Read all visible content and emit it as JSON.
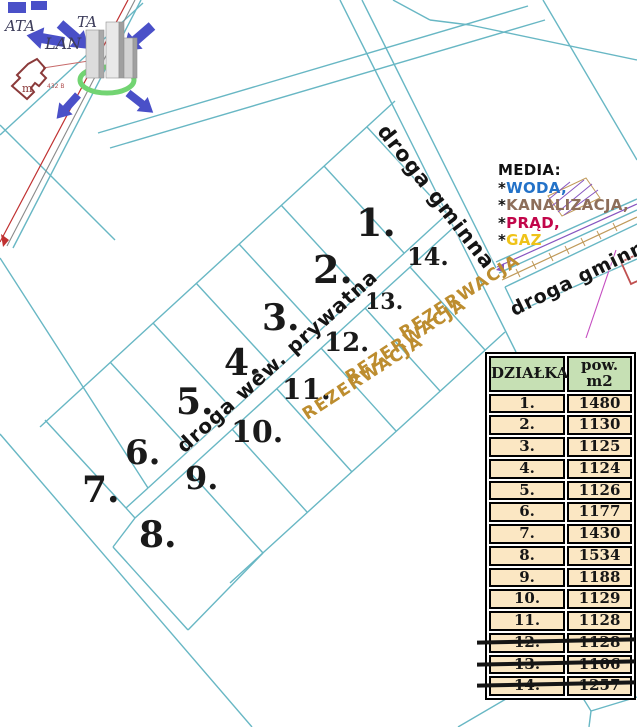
{
  "colors": {
    "parcel_line": "#68b7c4",
    "reservation_text": "#bd8d2f",
    "table_header_bg": "#c6e0b4",
    "table_row_bg": "#fbe7c3",
    "logo_blue": "#4a50c8",
    "logo_green": "#72d472",
    "red_line": "#c03030"
  },
  "logo": {
    "text_left": "ATA",
    "text_right": "TA",
    "text_bottom": "LAN"
  },
  "map": {
    "building_label": "m",
    "building_note": "432 B",
    "plots": [
      {
        "label": "1.",
        "x": 356,
        "y": 204,
        "fs": 38
      },
      {
        "label": "2.",
        "x": 313,
        "y": 251,
        "fs": 38
      },
      {
        "label": "3.",
        "x": 262,
        "y": 300,
        "fs": 36
      },
      {
        "label": "4.",
        "x": 224,
        "y": 345,
        "fs": 36
      },
      {
        "label": "5.",
        "x": 176,
        "y": 384,
        "fs": 36
      },
      {
        "label": "6.",
        "x": 125,
        "y": 436,
        "fs": 34
      },
      {
        "label": "7.",
        "x": 82,
        "y": 472,
        "fs": 36
      },
      {
        "label": "8.",
        "x": 139,
        "y": 517,
        "fs": 36
      },
      {
        "label": "9.",
        "x": 185,
        "y": 462,
        "fs": 32
      },
      {
        "label": "10.",
        "x": 231,
        "y": 418,
        "fs": 30
      },
      {
        "label": "11.",
        "x": 282,
        "y": 376,
        "fs": 28
      },
      {
        "label": "12.",
        "x": 324,
        "y": 330,
        "fs": 26
      },
      {
        "label": "13.",
        "x": 365,
        "y": 291,
        "fs": 22
      },
      {
        "label": "14.",
        "x": 407,
        "y": 245,
        "fs": 24
      }
    ],
    "reservations": [
      {
        "label": "REZERWACJA",
        "x": 460,
        "y": 297,
        "rot": -33
      },
      {
        "label": "REZERWACJA",
        "x": 406,
        "y": 341,
        "rot": -33
      },
      {
        "label": "REZERWACJA",
        "x": 363,
        "y": 378,
        "rot": -33
      }
    ],
    "roads": [
      {
        "label": "droga gminna",
        "x": 436,
        "y": 197,
        "rot": 52,
        "fs": 21
      },
      {
        "label": "droga wew. prywatna",
        "x": 277,
        "y": 361,
        "rot": -42,
        "fs": 20
      },
      {
        "label": "droga gminna",
        "x": 584,
        "y": 276,
        "rot": -26,
        "fs": 19
      }
    ]
  },
  "media": {
    "title": "MEDIA:",
    "items": [
      {
        "star": "*",
        "word": "WODA,",
        "color": "#2372c8"
      },
      {
        "star": "*",
        "word": "KANALIZACJA,",
        "color": "#8d6e5a"
      },
      {
        "star": "*",
        "word": "PRĄD,",
        "color": "#c2064a"
      },
      {
        "star": "*",
        "word": "GAZ",
        "color": "#efc319"
      }
    ]
  },
  "table": {
    "headers": [
      "DZIAŁKA",
      "pow. m2"
    ],
    "rows": [
      {
        "plot": "1.",
        "area": "1480",
        "struck": false
      },
      {
        "plot": "2.",
        "area": "1130",
        "struck": false
      },
      {
        "plot": "3.",
        "area": "1125",
        "struck": false
      },
      {
        "plot": "4.",
        "area": "1124",
        "struck": false
      },
      {
        "plot": "5.",
        "area": "1126",
        "struck": false
      },
      {
        "plot": "6.",
        "area": "1177",
        "struck": false
      },
      {
        "plot": "7.",
        "area": "1430",
        "struck": false
      },
      {
        "plot": "8.",
        "area": "1534",
        "struck": false
      },
      {
        "plot": "9.",
        "area": "1188",
        "struck": false
      },
      {
        "plot": "10.",
        "area": "1129",
        "struck": false
      },
      {
        "plot": "11.",
        "area": "1128",
        "struck": false
      },
      {
        "plot": "12.",
        "area": "1128",
        "struck": true
      },
      {
        "plot": "13.",
        "area": "1106",
        "struck": true
      },
      {
        "plot": "14.",
        "area": "1257",
        "struck": true
      }
    ]
  }
}
